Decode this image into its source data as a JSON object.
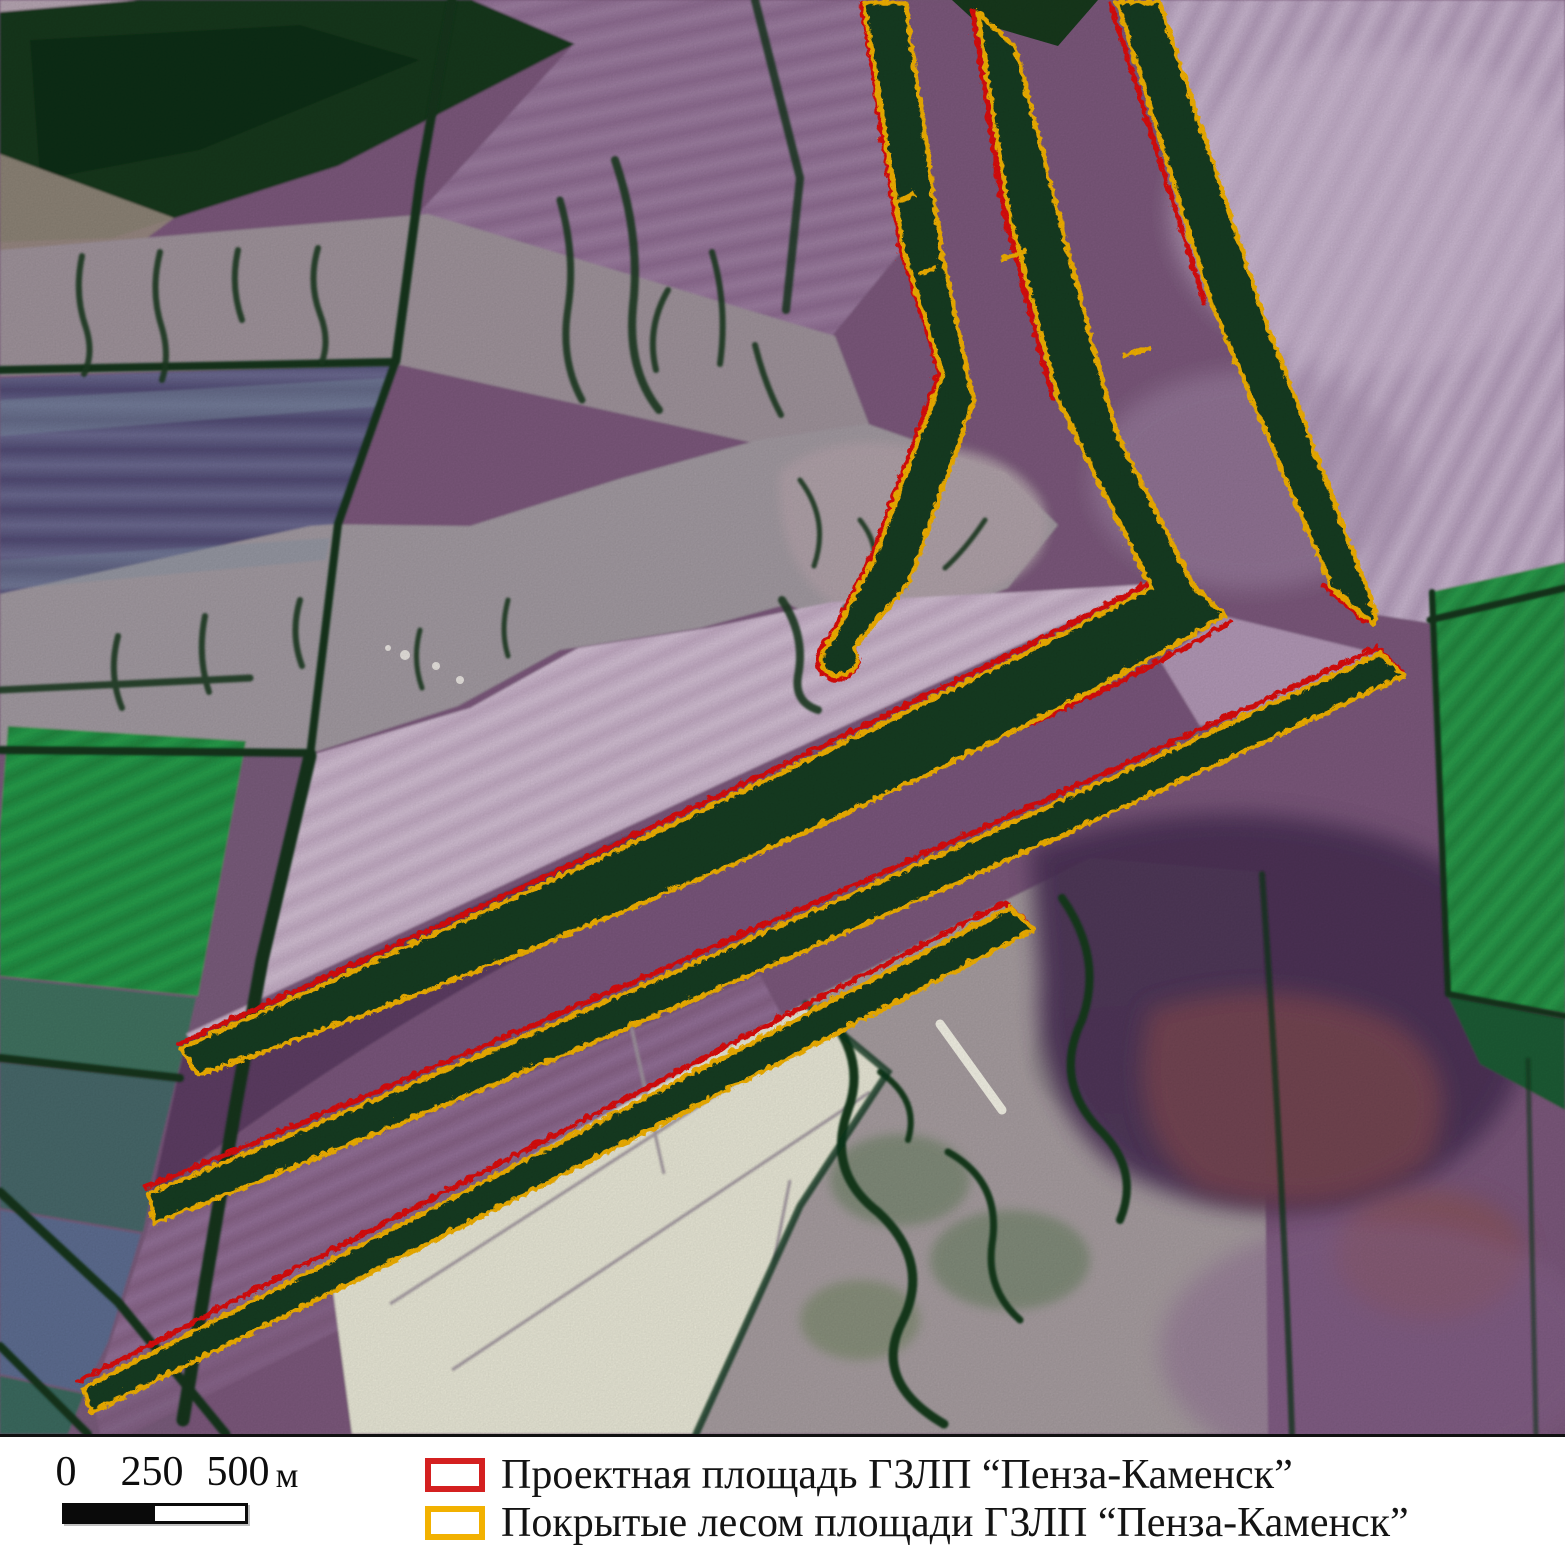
{
  "map": {
    "description": "false-color satellite image of agricultural fields with protective forest shelterbelts",
    "colors": {
      "field_purple_base": "#7b587b",
      "shelterbelt_green": "#143d20",
      "project_outline_red": "#dd1111",
      "forested_outline_yellow": "#f4b203",
      "white_field": "#e9e8d7",
      "bright_green_field": "#2ba14e"
    }
  },
  "legend": {
    "items": [
      {
        "id": "project-area",
        "label": "Проектная площадь ГЗЛП “Пенза-Каменск”",
        "swatch_color": "#d42020"
      },
      {
        "id": "forested-area",
        "label": "Покрытые лесом площади ГЗЛП “Пенза-Каменск”",
        "swatch_color": "#f2b100"
      }
    ]
  },
  "scalebar": {
    "tick_labels": [
      "0",
      "250",
      "500"
    ],
    "unit_label": "м"
  }
}
